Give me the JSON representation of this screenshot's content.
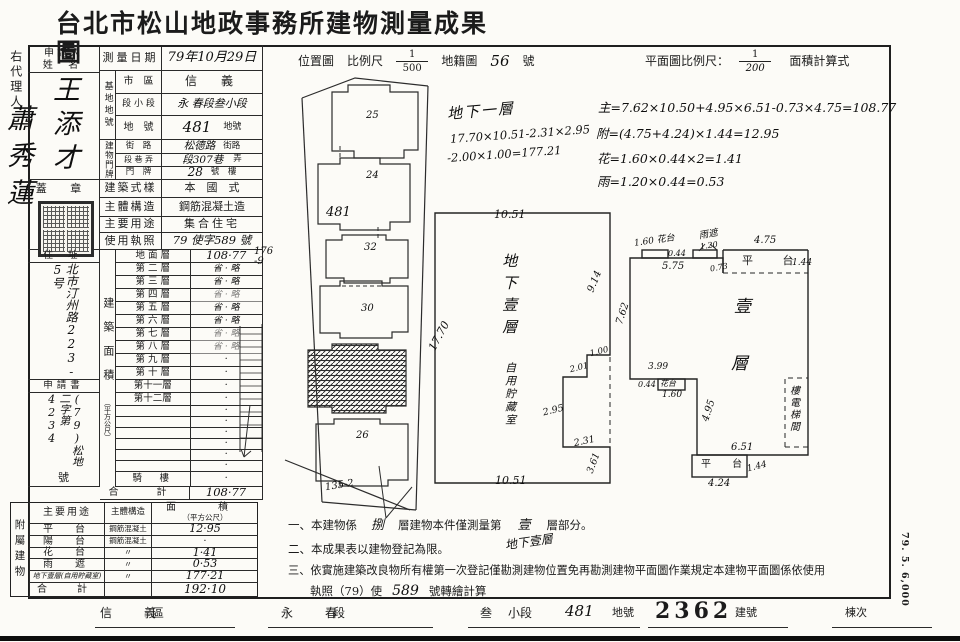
{
  "title": "台北市松山地政事務所建物測量成果圖",
  "margin": {
    "agent_label": "右代理人",
    "agent_name": "蕭秀蓮",
    "print_code": "79. 5. 6,000"
  },
  "form": {
    "applicant": {
      "label_line1": "申請人",
      "label_line2": "姓 名",
      "name": "王添才"
    },
    "seal_label": "蓋 章",
    "address": {
      "label": "住 址",
      "value": "北市汀州路223-5号"
    },
    "application": {
      "label": "申請書",
      "value": "(79)松地二字第4234",
      "suffix": "號"
    },
    "survey_date": {
      "label": "測量日期",
      "value": "79年10月29日"
    },
    "site": {
      "group_label": "基地地號",
      "rows": [
        {
          "label": "市　區",
          "value": "信　義",
          "suffix": ""
        },
        {
          "label": "段 小 段",
          "value": "永 春段叁小段",
          "suffix": ""
        },
        {
          "label": "地　號",
          "value": "481",
          "suffix": "地號"
        }
      ]
    },
    "premises": {
      "group_label": "建物門牌",
      "rows": [
        {
          "label": "街　路",
          "value": "松德路",
          "suffix": "街路"
        },
        {
          "label": "段 巷 弄",
          "value": "段307巷",
          "suffix": "弄"
        },
        {
          "label": "門　牌",
          "value": "28",
          "suffix": "號　樓"
        }
      ]
    },
    "style": {
      "label": "建築式樣",
      "value": "本　國　式"
    },
    "structure": {
      "label": "主體構造",
      "value": "鋼筋混凝土造"
    },
    "usage": {
      "label": "主要用途",
      "value": "集合住宅"
    },
    "license": {
      "label": "使用執照",
      "value": "79 使字589 號"
    },
    "floor_area": {
      "group_label": "建築面積",
      "unit": "（平方公尺）",
      "rows": [
        {
          "label": "地 面 層",
          "value": "108·77"
        },
        {
          "label": "第 二 層",
          "value": "省 · 略"
        },
        {
          "label": "第 三 層",
          "value": "省 · 略"
        },
        {
          "label": "第 四 層",
          "value": "省 · 略"
        },
        {
          "label": "第 五 層",
          "value": "省 · 略"
        },
        {
          "label": "第 六 層",
          "value": "省 · 略"
        },
        {
          "label": "第 七 層",
          "value": "省 · 略"
        },
        {
          "label": "第 八 層",
          "value": "省 · 略"
        },
        {
          "label": "第 九 層",
          "value": "·"
        },
        {
          "label": "第 十 層",
          "value": "·"
        },
        {
          "label": "第十一層",
          "value": "·"
        },
        {
          "label": "第十二層",
          "value": "·"
        },
        {
          "label": "",
          "value": "·"
        },
        {
          "label": "",
          "value": "·"
        },
        {
          "label": "",
          "value": "·"
        },
        {
          "label": "",
          "value": "·"
        },
        {
          "label": "",
          "value": "·"
        },
        {
          "label": "",
          "value": "·"
        },
        {
          "label": "騎　樓",
          "value": "·"
        }
      ],
      "total_label": "合　計",
      "total_value": "108·77"
    }
  },
  "annex": {
    "group_label": "附屬建物",
    "col_use": "主要用途",
    "col_structure": "主體構造",
    "col_area1": "面　積",
    "col_area2": "（平方公尺）",
    "rows": [
      {
        "use": "平　台",
        "structure": "鋼筋混凝土",
        "area": "12·95"
      },
      {
        "use": "陽　台",
        "structure": "鋼筋混凝土",
        "area": "·"
      },
      {
        "use": "花　台",
        "structure": "〃",
        "area": "1·41"
      },
      {
        "use": "雨　遮",
        "structure": "〃",
        "area": "0·53"
      },
      {
        "use": "地下壹層(自用貯藏室)",
        "structure": "〃",
        "area": "177·21"
      },
      {
        "use": "合　計",
        "structure": "",
        "area": "192·10"
      }
    ]
  },
  "map_header": {
    "location": "位置圖",
    "scale_label": "比例尺",
    "scale_num": "1",
    "scale_den": "500",
    "cadastre": "地籍圖",
    "cadastre_no": "56",
    "cadastre_suffix": "號",
    "plan_scale_label": "平面圖比例尺：",
    "plan_num": "1",
    "plan_den": "200",
    "calc_label": "面積計算式"
  },
  "location_map": {
    "p25": "25",
    "p24": "24",
    "p481": "481",
    "p32": "32",
    "p30": "30",
    "p26": "26",
    "p1352": "135-2",
    "p176": "176\n-9"
  },
  "basement": {
    "calc_title": "地下一層",
    "calc1": "17.70×10.51-2.31×2.95",
    "calc2": "-2.00×1.00=177.21",
    "room1": "地下壹層",
    "room2": "自用貯藏室",
    "d_top": "10.51",
    "d_left": "17.70",
    "d_right": "9.14",
    "d1": "1.00",
    "d2": "2.01",
    "d3": "2.95",
    "d4": "2.31",
    "d5": "3.61",
    "d_bottom": "10.51"
  },
  "formulas": {
    "f1": "主=7.62×10.50+4.95×6.51-0.73×4.75=108.77",
    "f2": "附=(4.75+4.24)×1.44=12.95",
    "f3": "花=1.60×0.44×2=1.41",
    "f4": "雨=1.20×0.44=0.53"
  },
  "plan": {
    "floor_char1": "壹",
    "floor_char2": "層",
    "flower_top": "1.60 花台",
    "d044a": "0.44",
    "rain_label": "雨遮",
    "d120": "1.20",
    "d475": "4.75",
    "terrace_top": "平 台",
    "d144a": "1.44",
    "d575": "5.75",
    "d073": "0.73",
    "d762": "7.62",
    "d399": "3.99",
    "d044b": "0.44",
    "flower_left": "花台",
    "d160": "1.60",
    "d495": "4.95",
    "stairs": "樓電梯間",
    "d651": "6.51",
    "terrace_bottom": "平 台",
    "d144b": "1.44",
    "d424": "4.24"
  },
  "notes": {
    "n1a": "一、本建物係",
    "n1_num": "捌",
    "n1b": "層建物本件僅測量第",
    "n1_val": "壹",
    "n1c": "層部分。",
    "n1_annot": "地下壹層",
    "n2": "二、本成果表以建物登記為限。",
    "n3a": "三、依實施建築改良物所有權第一次登記僅勘測建物位置免再勘測建物平面圖作業規定本建物平面圖係依使用",
    "n3b": "執照（79）使",
    "n3_num": "589",
    "n3c": "號轉繪計算"
  },
  "footer": {
    "district": "信　義",
    "district_sfx": "區",
    "section": "永　春",
    "section_sfx": "段",
    "sub": "叁",
    "sub_sfx": "小段",
    "land": "481",
    "land_sfx": "地號",
    "bldg": "2362",
    "bldg_sfx": "建號",
    "block": "棟次"
  }
}
